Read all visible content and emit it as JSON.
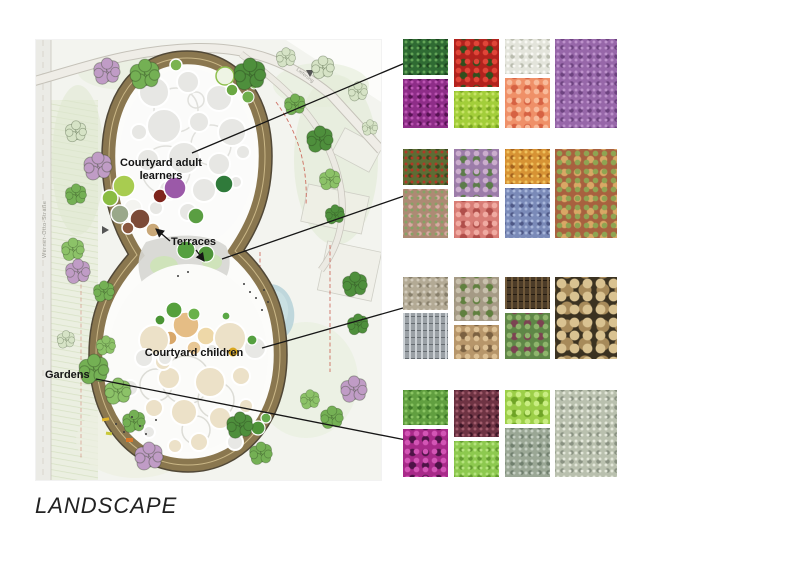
{
  "page": {
    "title": "LANDSCAPE"
  },
  "plan": {
    "street_label": "Werner-Otto-Straße",
    "delivery_label": "Lieferung",
    "labels": {
      "courtyard_adult": "Courtyard adult learners",
      "terraces": "Terraces",
      "courtyard_children": "Courtyard children",
      "gardens": "Gardens"
    },
    "palette": {
      "building_ring": "#8a774f",
      "building_outline": "#514837",
      "courtyard_white": "#fbfbfa",
      "canopy_grey": "#e7e7e4",
      "tree_green": "#74b054",
      "tree_green_dark": "#4e8f3c",
      "tree_green_light": "#8cc268",
      "tree_purple": "#c09cc6",
      "pond_blue": "#b9d4d9",
      "sand_tan": "#e5bd85",
      "route_dashed_red": "#c44536",
      "leader_line": "#161616"
    }
  },
  "collages": [
    {
      "title": "courtyard adult learners planting",
      "tiles": [
        {
          "name": "dark-green-foliage",
          "c1": "#2f6b33",
          "c2": "#63a457",
          "c3": "#1c451f",
          "tex": "fine"
        },
        {
          "name": "magenta-flowers",
          "c1": "#8e2d88",
          "c2": "#bb55b2",
          "c3": "#571253",
          "tex": "fine"
        },
        {
          "name": "red-berries",
          "c1": "#b2221d",
          "c2": "#e04538",
          "c3": "#314f1d",
          "tex": "coarse"
        },
        {
          "name": "lime-foliage",
          "c1": "#a3ce3a",
          "c2": "#c8e468",
          "c3": "#7aa622",
          "tex": "fine"
        },
        {
          "name": "white-seedheads",
          "c1": "#e3e4db",
          "c2": "#f8f8f3",
          "c3": "#b9bcae",
          "tex": "fine"
        },
        {
          "name": "salmon-flowers",
          "c1": "#ef9068",
          "c2": "#f8bb9b",
          "c3": "#d66243",
          "tex": "coarse"
        },
        {
          "name": "purple-flower-carpet",
          "c1": "#9767a9",
          "c2": "#bd92cb",
          "c3": "#6d4380",
          "tex": "fine"
        }
      ]
    },
    {
      "title": "terraces roof planting",
      "tiles": [
        {
          "name": "red-green-groundcover",
          "c1": "#5d6d34",
          "c2": "#b03a27",
          "c3": "#394a1f",
          "tex": "fine"
        },
        {
          "name": "sedum-pink-green",
          "c1": "#ad8a74",
          "c2": "#86a265",
          "c3": "#d7aaa2",
          "tex": "fine"
        },
        {
          "name": "ornamental-kale",
          "c1": "#9c7ca9",
          "c2": "#cbadcd",
          "c3": "#5c7c4a",
          "tex": "coarse"
        },
        {
          "name": "pink-succulent",
          "c1": "#d87d76",
          "c2": "#f0aba2",
          "c3": "#b04e4a",
          "tex": "coarse"
        },
        {
          "name": "orange-sedum",
          "c1": "#d79334",
          "c2": "#f0c25e",
          "c3": "#a3611e",
          "tex": "fine"
        },
        {
          "name": "blue-flowers",
          "c1": "#7a8ab8",
          "c2": "#a7b6da",
          "c3": "#4e5886",
          "tex": "fine"
        },
        {
          "name": "mixed-sedum-mat",
          "c1": "#a8613f",
          "c2": "#8fa452",
          "c3": "#d9a765",
          "tex": "coarse"
        }
      ]
    },
    {
      "title": "courtyard children materials",
      "tiles": [
        {
          "name": "gravel-path",
          "c1": "#b3aa95",
          "c2": "#d2cbbb",
          "c3": "#877f6b",
          "tex": "fine"
        },
        {
          "name": "stone-drainage-channel",
          "c1": "#9aa0a5",
          "c2": "#ccd1d5",
          "c3": "#666c71",
          "tex": "stripes"
        },
        {
          "name": "stone-paving",
          "c1": "#a59a85",
          "c2": "#c8c0ac",
          "c3": "#60803f",
          "tex": "coarse"
        },
        {
          "name": "timber-steps",
          "c1": "#b7966a",
          "c2": "#dcc094",
          "c3": "#7b6141",
          "tex": "coarse"
        },
        {
          "name": "log-wall",
          "c1": "#4b3b28",
          "c2": "#70593a",
          "c3": "#241b10",
          "tex": "stripes"
        },
        {
          "name": "planting-bed",
          "c1": "#5f8747",
          "c2": "#8fb56c",
          "c3": "#7c4352",
          "tex": "coarse"
        },
        {
          "name": "log-pile",
          "c1": "#3b3221",
          "c2": "#d9c291",
          "c3": "#a78a5a",
          "tex": "logs"
        }
      ]
    },
    {
      "title": "gardens planting",
      "tiles": [
        {
          "name": "green-hedge",
          "c1": "#619f40",
          "c2": "#8ac463",
          "c3": "#3d7827",
          "tex": "fine"
        },
        {
          "name": "magenta-tulips",
          "c1": "#a82a89",
          "c2": "#d355b5",
          "c3": "#4e1347",
          "tex": "coarse"
        },
        {
          "name": "red-leaf-shrub",
          "c1": "#6e3343",
          "c2": "#a05c6c",
          "c3": "#3c1626",
          "tex": "fine"
        },
        {
          "name": "light-green-shrub",
          "c1": "#8dc94f",
          "c2": "#b5e37e",
          "c3": "#639b2f",
          "tex": "fine"
        },
        {
          "name": "chartreuse-foliage",
          "c1": "#9ccf48",
          "c2": "#c9ed82",
          "c3": "#6fa426",
          "tex": "coarse"
        },
        {
          "name": "silver-foliage",
          "c1": "#9aa795",
          "c2": "#c5cfc2",
          "c3": "#707f6e",
          "tex": "fine"
        },
        {
          "name": "silver-tree",
          "c1": "#b9c0ae",
          "c2": "#e3e7da",
          "c3": "#8a9282",
          "tex": "fine"
        }
      ]
    }
  ]
}
